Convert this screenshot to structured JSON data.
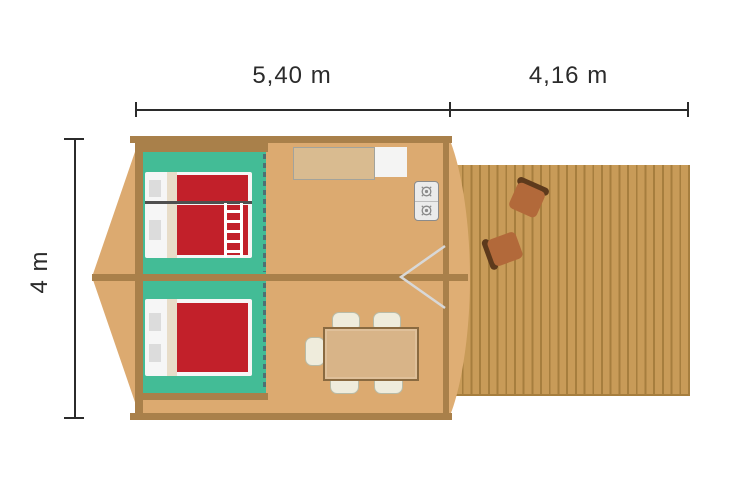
{
  "dimension_labels": {
    "tent_width": "5,40 m",
    "terrace_width": "4,16 m",
    "depth": "4 m"
  },
  "colors": {
    "canvas_floor": "#dcaa70",
    "wall": "#a9804a",
    "terrace_wood": "#c89b58",
    "terrace_plank_line": "#a67e3e",
    "bedroom_floor": "#43bc96",
    "bed_blanket_red": "#c2202a",
    "bed_linen_white": "#f6f6f6",
    "pillow_gray": "#dcdcdc",
    "kitchen_counter": "#d9bb90",
    "dining_table": "#d8b488",
    "dining_chair": "#efecdc",
    "lounge_chair": "#b2693a",
    "lounge_chair_back": "#5d3a1c",
    "partition_dash": "#4c7174",
    "door_swing_line": "#d8d8d8",
    "dimension_line": "#2b2b2b"
  },
  "icons": [
    "bunk-bed-icon",
    "double-bed-icon",
    "ladder-icon",
    "stove-burner-icon",
    "kitchen-counter-icon",
    "sink-icon",
    "dining-table-icon",
    "dining-chair-icon",
    "door-swing-icon",
    "lounge-chair-icon",
    "curtain-partition-icon"
  ]
}
